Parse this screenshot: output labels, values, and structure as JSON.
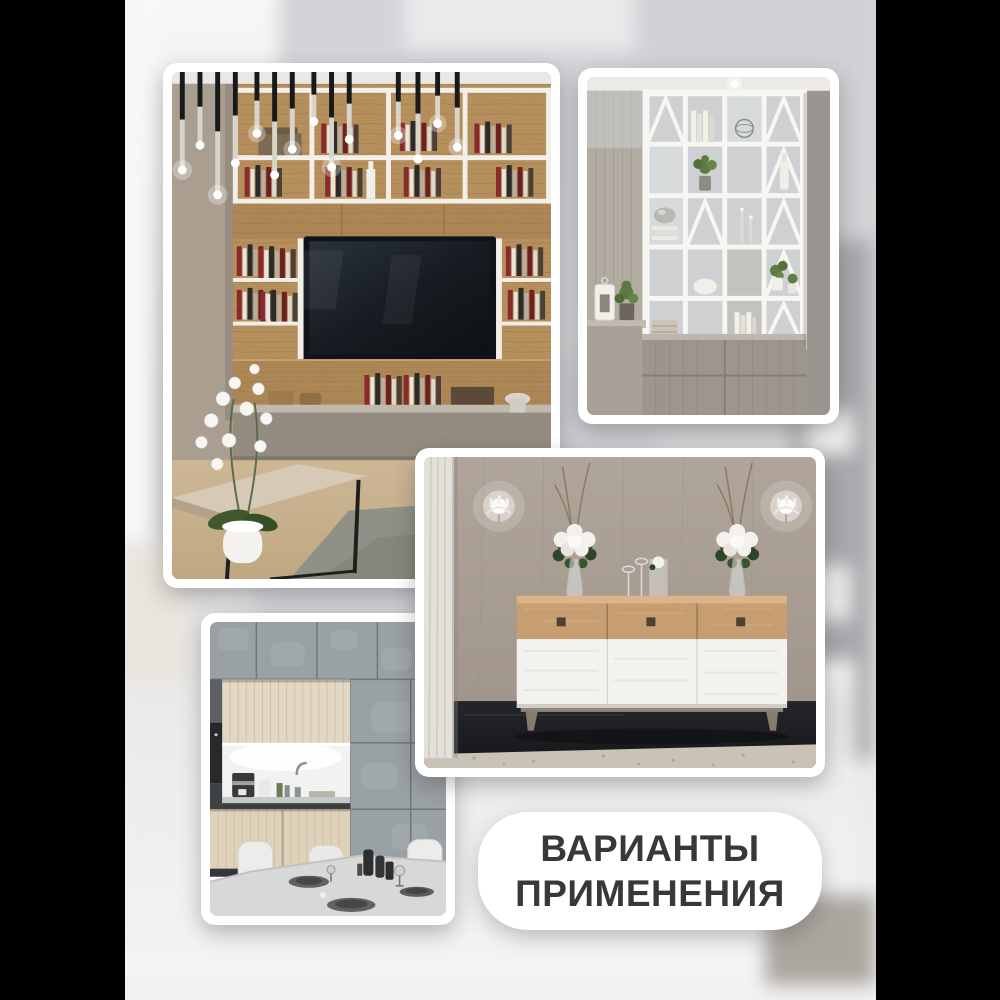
{
  "page": {
    "pillarbox_color": "#000000",
    "backdrop_top_color": "#d3d4d7",
    "backdrop_bottom_color": "#f2f2f3"
  },
  "badge": {
    "line1": "ВАРИАНТЫ",
    "line2": "ПРИМЕНЕНИЯ",
    "bg_color": "#ffffff",
    "text_color": "#38373b"
  },
  "photos": [
    {
      "id": "living-room-wall-unit",
      "alt": "Living room with light-oak wall unit, open bookshelves, mounted TV, pendant lights, white orchid and coffee table"
    },
    {
      "id": "white-shelving-divider",
      "alt": "White open-shelving room divider with plants, books and candles over grey weathered-wood base cabinets"
    },
    {
      "id": "sideboard-with-flowers",
      "alt": "Oak and white three-drawer sideboard with two vases of white roses, wall sconces and dark floor"
    },
    {
      "id": "kitchen-dining",
      "alt": "Grey concrete-panel kitchen with light wood fronts, lit niche, coffee machine and set dining table"
    }
  ]
}
